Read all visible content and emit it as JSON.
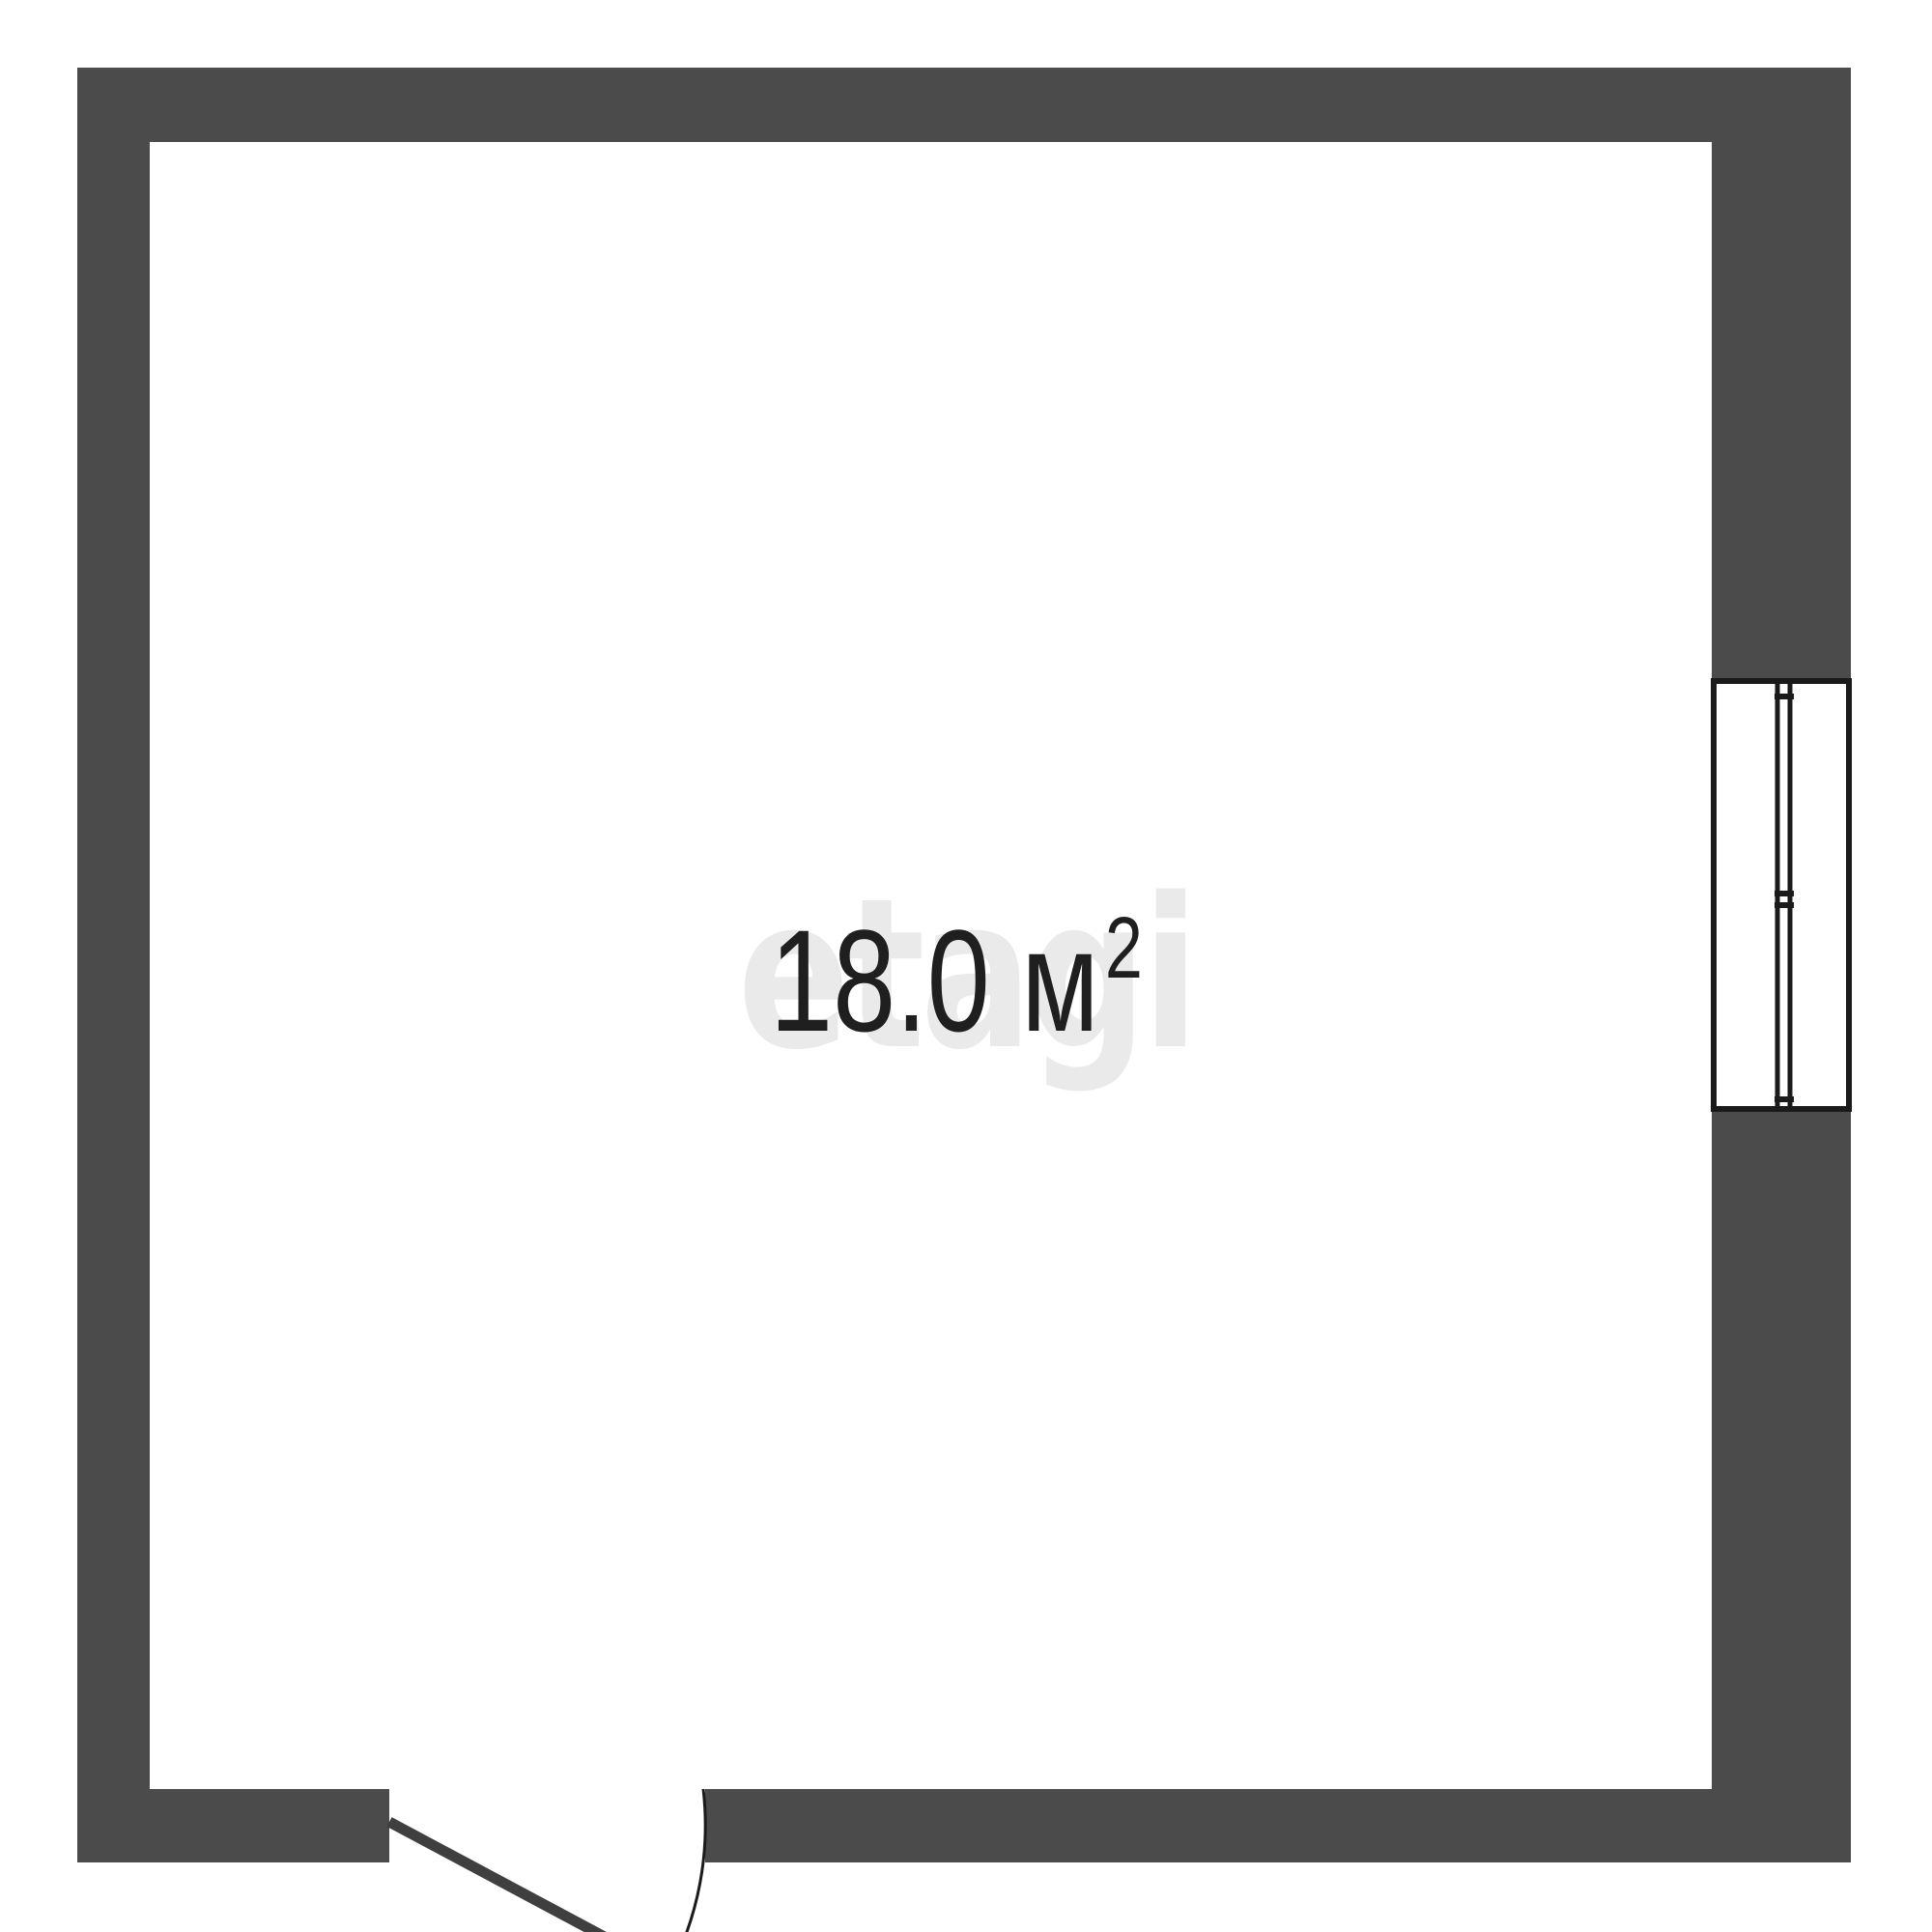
{
  "floorplan": {
    "area_text": "18.0 м",
    "area_sup": "2",
    "watermark_text": "etagi",
    "colors": {
      "wall": "#4b4b4b",
      "line": "#1a1a1a",
      "door": "#3f3f3f",
      "text": "#1f1f1f",
      "watermark": "#eaeaea",
      "room_fill": "#ffffff"
    }
  }
}
